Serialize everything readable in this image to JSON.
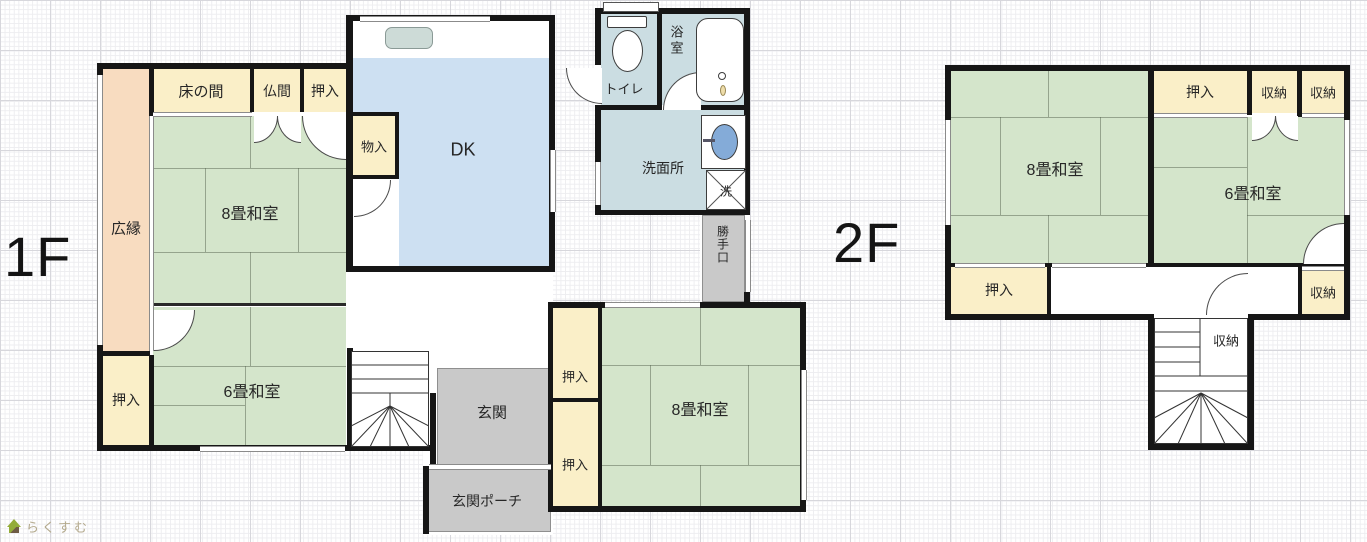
{
  "floor1": {
    "label": "1F",
    "hiroen": "広縁",
    "tokonoma": "床の間",
    "butsuma": "仏間",
    "oshiire_top": "押入",
    "oshiire_left": "押入",
    "oshiire_a": "押入",
    "oshiire_b": "押入",
    "monoire": "物入",
    "dk": "DK",
    "toilet": "トイレ",
    "bath": "浴室",
    "washroom": "洗面所",
    "washer": "洗",
    "katteguchi": "勝手口",
    "washitsu8_main": "8畳和室",
    "washitsu6": "6畳和室",
    "washitsu8_south": "8畳和室",
    "genkan": "玄関",
    "porch": "玄関ポーチ"
  },
  "floor2": {
    "label": "2F",
    "oshiire_top": "押入",
    "shuno_1": "収納",
    "shuno_2": "収納",
    "washitsu8": "8畳和室",
    "washitsu6": "6畳和室",
    "oshiire_bottom": "押入",
    "shuno_3": "収納",
    "shuno_4": "収納"
  },
  "logo": {
    "text": "らくすむ"
  },
  "colors": {
    "tatami_green": "#d4e5cb",
    "closet_cream": "#faefc8",
    "veranda_peach": "#f8dcc0",
    "dk_blue": "#cde0f2",
    "wet_blue": "#cbdde2",
    "entry_gray": "#c9c9c9",
    "wall_black": "#161616",
    "sink_blue": "#84abd8"
  }
}
